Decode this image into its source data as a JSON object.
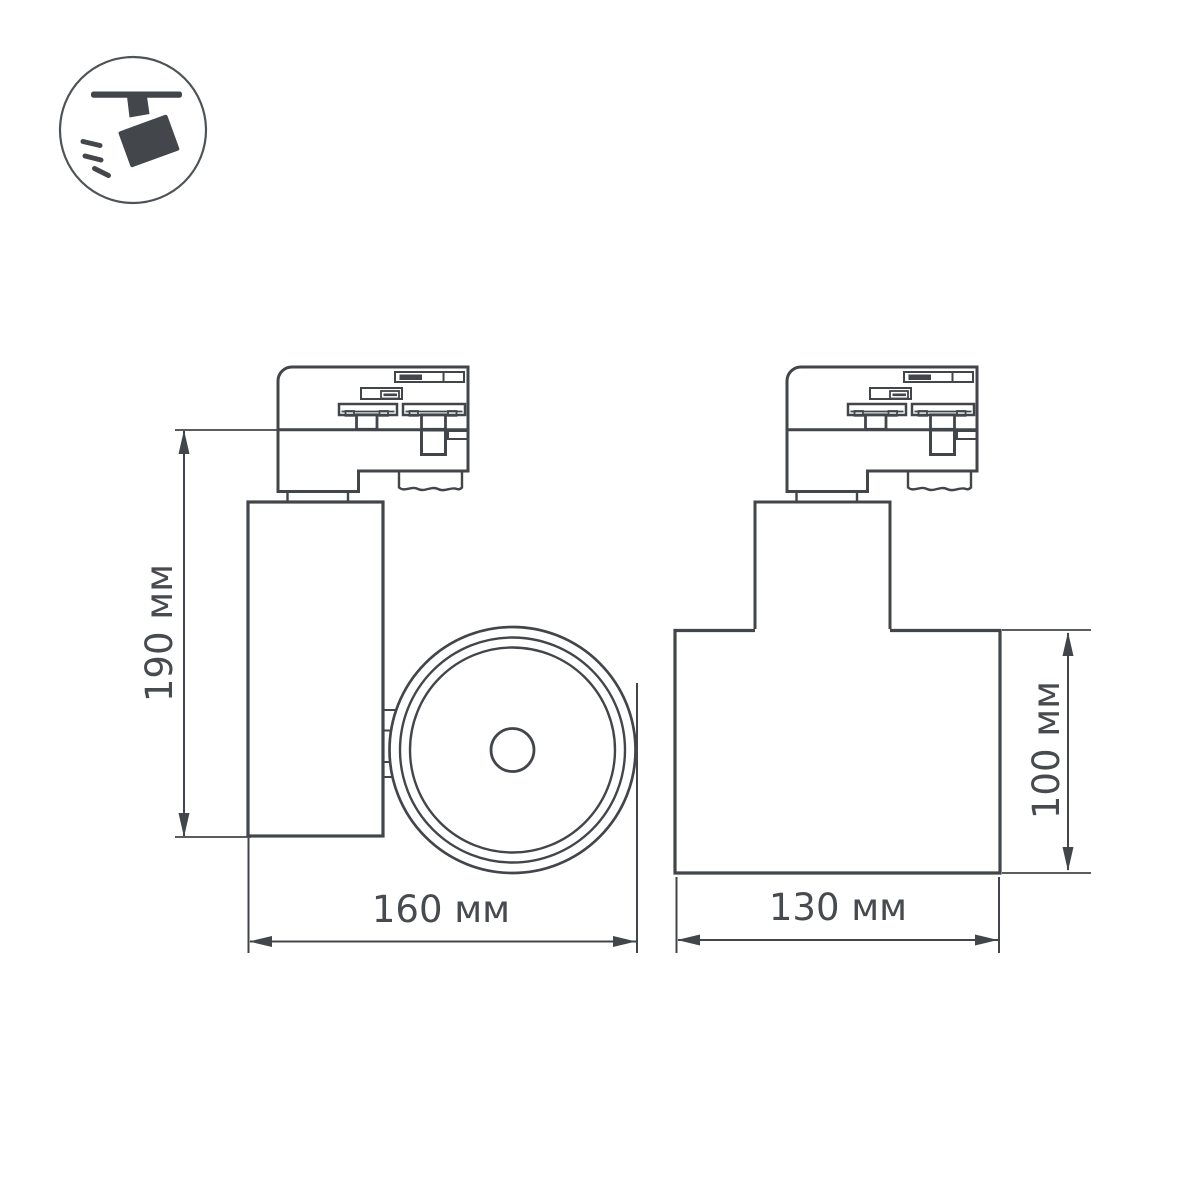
{
  "page": {
    "background_color": "#ffffff"
  },
  "legend_icon": {
    "name": "track-spotlight",
    "glyph_color": "#43474b",
    "ring_color": "#4e5357"
  },
  "drawing": {
    "type": "technical-dimension-drawing",
    "subject": "track light fixture, two orthographic views",
    "line_color": "#42464a",
    "text_color": "#474a4e",
    "dimensions": {
      "side_height": "190 мм",
      "side_width": "160 мм",
      "rear_width": "130 мм",
      "rear_height": "100 мм"
    }
  }
}
